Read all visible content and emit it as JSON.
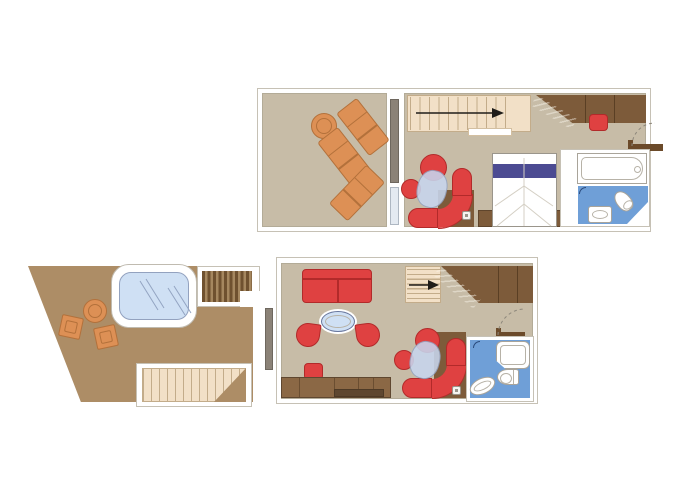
{
  "palette": {
    "floor_light": "#c7bca7",
    "floor_terrace": "#ad8d66",
    "wall_line": "#b3ab97",
    "frame_line": "#c6c1b5",
    "wood_dark": "#7d5b3a",
    "wood_seam": "#5a3f24",
    "wood_desk": "#8b6845",
    "desk_recess": "#5f4730",
    "door_wood": "#6b4a2a",
    "stairs_cream": "#f2e0c7",
    "stairs_tread": "#c3ac8a",
    "stripe_dark": "#6f512f",
    "stripe_mid": "#a5875f",
    "red": "#df4141",
    "red_dark": "#b22a2a",
    "orange": "#dd9055",
    "orange_dark": "#b3713b",
    "glass_blue": "#cfe0f4",
    "glass_soft": "#c7d6ee",
    "glass_border": "#94a3c1",
    "bath_blue": "#6f9fd7",
    "navy": "#4c4b92",
    "fixture_line": "#a9a49a",
    "inner_line": "#b7b2a7",
    "arrow": "#1f1d1a",
    "dash_line": "#8d877b",
    "fold_line": "#d4cfc4",
    "reflect_line": "#93a4c2"
  },
  "upper_plan": {
    "balcony": {
      "furniture": [
        "round-side-table",
        "sun-lounger",
        "sun-lounger",
        "sun-lounger"
      ],
      "door": "sliding-glass-door"
    },
    "interior": {
      "furniture": [
        "staircase-with-up-arrow",
        "wardrobe",
        "red-ottoman",
        "curved-sofa",
        "round-armchair",
        "round-side-chair",
        "glass-coffee-table",
        "double-bed-with-pillow-band",
        "console-cabinet",
        "entrance-door"
      ]
    },
    "bathroom": {
      "fixtures": [
        "bathtub",
        "washbasin",
        "toilet",
        "shower-hook"
      ]
    }
  },
  "lower_plan": {
    "terrace": {
      "features": [
        "whirlpool-hot-tub",
        "round-table",
        "deck-chair",
        "deck-chair",
        "exterior-stairs-dark",
        "deck-steps-light"
      ],
      "door": "sliding-glass-door"
    },
    "living_room": {
      "furniture": [
        "two-seat-sofa",
        "oval-glass-table",
        "tub-chair",
        "tub-chair",
        "footstool",
        "desk-console-with-recess",
        "staircase-with-up-arrow",
        "wardrobe",
        "curved-sofa",
        "round-armchair",
        "round-side-chair",
        "glass-coffee-table",
        "entrance-door"
      ]
    },
    "bathroom": {
      "fixtures": [
        "shower-pan",
        "toilet",
        "washbasin",
        "shower-hook"
      ]
    }
  }
}
